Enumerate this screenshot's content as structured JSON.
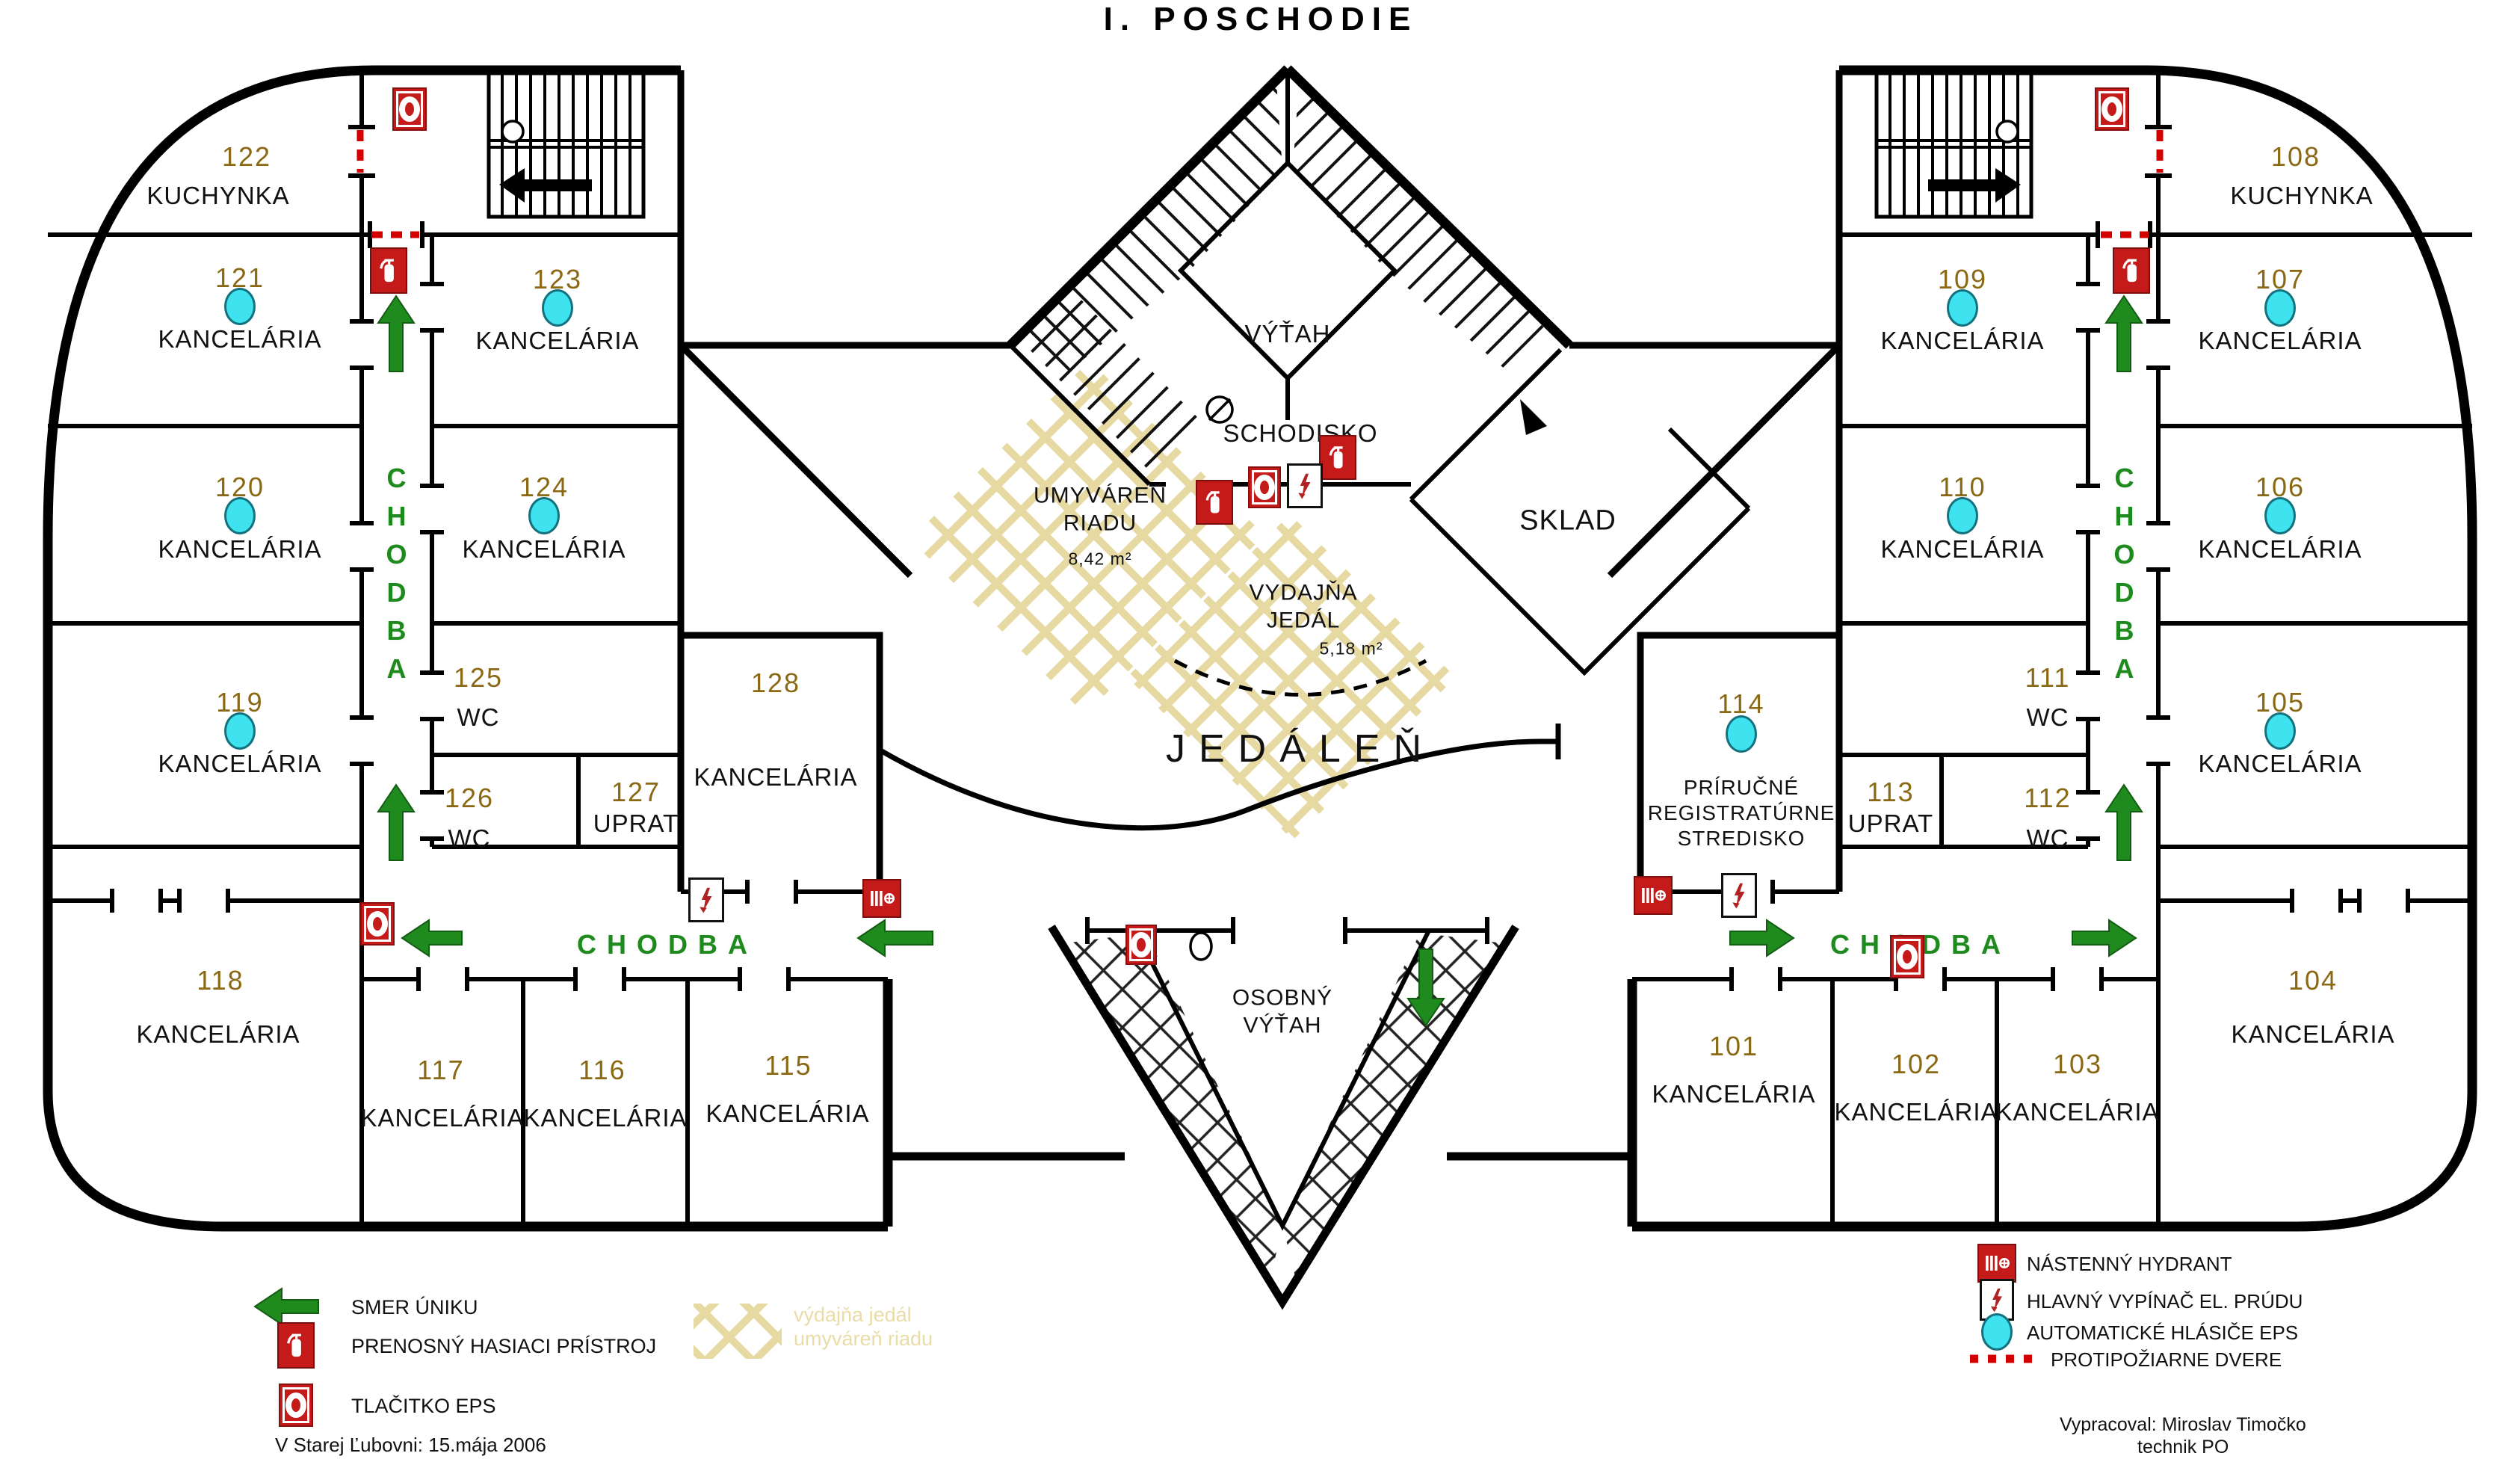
{
  "title": "I. POSCHODIE",
  "colors": {
    "room_number": "#8B6914",
    "label_black": "#111111",
    "corridor_green": "#1E8A1E",
    "fire_red": "#C41A1A",
    "detector_cyan": "#3FE3F0",
    "hatch_beige": "#E7D9A2",
    "wall": "#000000"
  },
  "rooms": [
    {
      "number": "122",
      "name": "KUCHYNKA",
      "detector": false
    },
    {
      "number": "121",
      "name": "KANCELÁRIA",
      "detector": true
    },
    {
      "number": "120",
      "name": "KANCELÁRIA",
      "detector": true
    },
    {
      "number": "119",
      "name": "KANCELÁRIA",
      "detector": true
    },
    {
      "number": "123",
      "name": "KANCELÁRIA",
      "detector": true
    },
    {
      "number": "124",
      "name": "KANCELÁRIA",
      "detector": true
    },
    {
      "number": "125",
      "name": "WC",
      "detector": false
    },
    {
      "number": "126",
      "name": "WC",
      "detector": false
    },
    {
      "number": "127",
      "name": "UPRAT",
      "detector": false
    },
    {
      "number": "128",
      "name": "KANCELÁRIA",
      "detector": false
    },
    {
      "number": "118",
      "name": "KANCELÁRIA",
      "detector": false
    },
    {
      "number": "117",
      "name": "KANCELÁRIA",
      "detector": false
    },
    {
      "number": "116",
      "name": "KANCELÁRIA",
      "detector": false
    },
    {
      "number": "115",
      "name": "KANCELÁRIA",
      "detector": false
    },
    {
      "number": "108",
      "name": "KUCHYNKA",
      "detector": false
    },
    {
      "number": "107",
      "name": "KANCELÁRIA",
      "detector": true
    },
    {
      "number": "106",
      "name": "KANCELÁRIA",
      "detector": true
    },
    {
      "number": "105",
      "name": "KANCELÁRIA",
      "detector": true
    },
    {
      "number": "109",
      "name": "KANCELÁRIA",
      "detector": true
    },
    {
      "number": "110",
      "name": "KANCELÁRIA",
      "detector": true
    },
    {
      "number": "111",
      "name": "WC",
      "detector": false
    },
    {
      "number": "112",
      "name": "WC",
      "detector": false
    },
    {
      "number": "113",
      "name": "UPRAT",
      "detector": false
    },
    {
      "number": "114",
      "name": "PRÍRUČNÉ REGISTRATÚRNE STREDISKO",
      "detector": true
    },
    {
      "number": "101",
      "name": "KANCELÁRIA",
      "detector": false
    },
    {
      "number": "102",
      "name": "KANCELÁRIA",
      "detector": false
    },
    {
      "number": "103",
      "name": "KANCELÁRIA",
      "detector": false
    },
    {
      "number": "104",
      "name": "KANCELÁRIA",
      "detector": false
    }
  ],
  "areas": {
    "vytah": "VÝŤAH",
    "schodisko": "SCHODISKO",
    "sklad": "SKLAD",
    "umyvaren": {
      "name": "UMYVÁREŇ RIADU",
      "area": "8,42 m²"
    },
    "vydajna": {
      "name": "VYDAJŇA JEDÁL",
      "area": "5,18 m²"
    },
    "jedalen": "JEDÁLEŇ",
    "osobny_vytah": "OSOBNÝ VÝŤAH",
    "chodba": "CHODBA"
  },
  "legend": {
    "smer_uniku": "SMER ÚNIKU",
    "hasiaci": "PRENOSNÝ HASIACI PRÍSTROJ",
    "tlacitko": "TLAČITKO EPS",
    "hydrant": "NÁSTENNÝ HYDRANT",
    "vypinac": "HLAVNÝ VYPÍNAČ EL. PRÚDU",
    "hlasice": "AUTOMATICKÉ HLÁSIČE EPS",
    "dvere": "PROTIPOŽIARNE DVERE",
    "watermark1": "výdajňa jedál",
    "watermark2": "umyváreň riadu",
    "date": "V Starej Ľubovni: 15.mája 2006",
    "author1": "Vypracoval: Miroslav Timočko",
    "author2": "technik PO"
  }
}
